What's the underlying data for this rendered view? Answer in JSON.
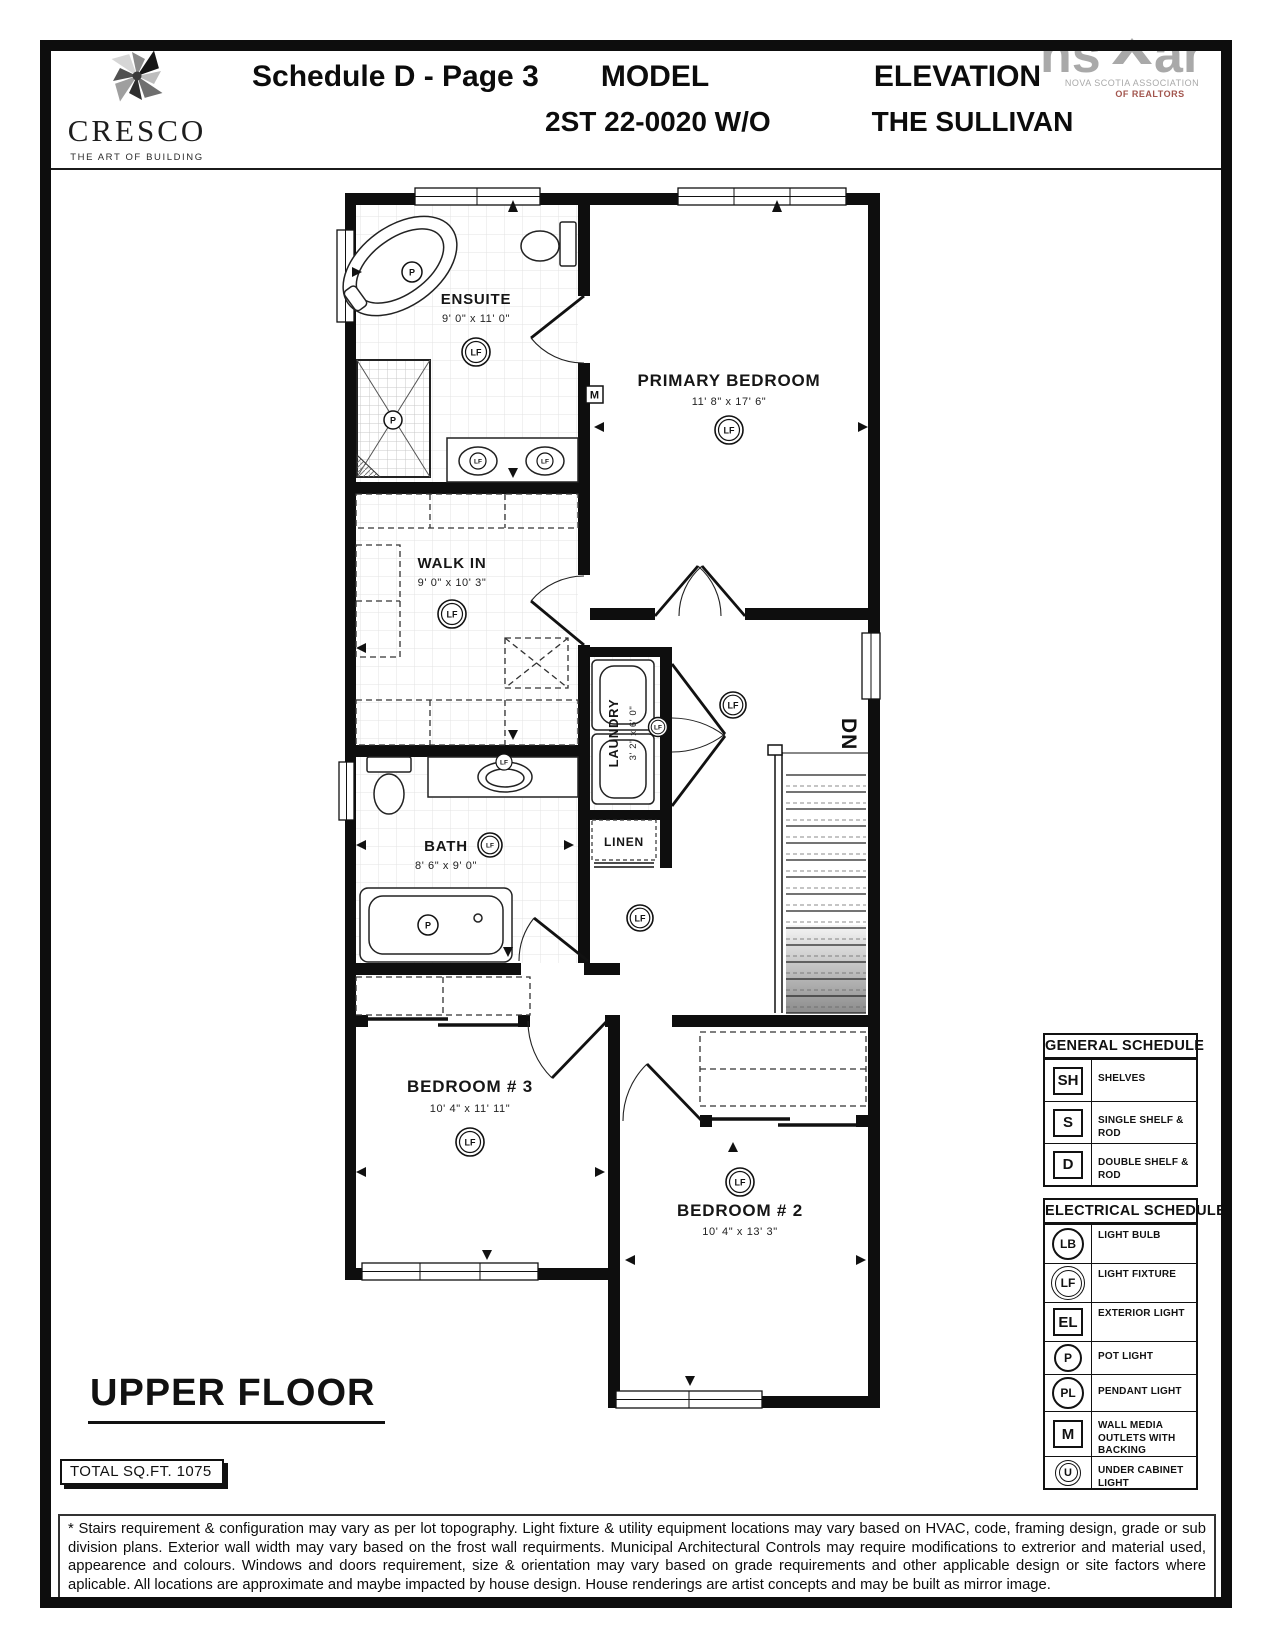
{
  "colors": {
    "ink": "#111111",
    "nsar_grey": "#a9a9a9",
    "realtors_red": "#a2554d",
    "tile_line": "#e3e3e3",
    "stair_shade": "#8c8c8c"
  },
  "header": {
    "cresco_name": "CRESCO",
    "cresco_tagline": "THE ART OF BUILDING",
    "schedule_title": "Schedule D - Page 3",
    "model_label": "MODEL",
    "model_value": "2ST 22-0020 W/O",
    "elevation_label": "ELEVATION",
    "elevation_value": "THE SULLIVAN",
    "nsar": {
      "logo_left": "ns",
      "logo_right": "ar",
      "org_line1": "NOVA SCOTIA ASSOCIATION",
      "org_line2": "OF REALTORS"
    }
  },
  "floorplan": {
    "floor_title": "UPPER FLOOR",
    "total_sqft": "TOTAL SQ.FT. 1075",
    "stairs_label": "DN",
    "symbols": {
      "light_fixture": "LF",
      "pot_light": "P",
      "media_outlet": "M"
    },
    "rooms": [
      {
        "name": "ENSUITE",
        "dims": "9' 0\" x 11' 0\""
      },
      {
        "name": "PRIMARY BEDROOM",
        "dims": "11' 8\" x 17' 6\""
      },
      {
        "name": "WALK IN",
        "dims": "9' 0\" x 10' 3\""
      },
      {
        "name": "LAUNDRY",
        "dims": "3' 2\" x 6' 0\""
      },
      {
        "name": "LINEN",
        "dims": ""
      },
      {
        "name": "BATH",
        "dims": "8' 6\" x 9' 0\""
      },
      {
        "name": "BEDROOM # 3",
        "dims": "10' 4\" x 11' 11\""
      },
      {
        "name": "BEDROOM # 2",
        "dims": "10' 4\" x 13' 3\""
      }
    ]
  },
  "general_schedule": {
    "title": "GENERAL SCHEDULE",
    "rows": [
      {
        "symbol": "SH",
        "label": "SHELVES"
      },
      {
        "symbol": "S",
        "label": "SINGLE SHELF & ROD"
      },
      {
        "symbol": "D",
        "label": "DOUBLE SHELF & ROD"
      }
    ]
  },
  "electrical_schedule": {
    "title": "ELECTRICAL SCHEDULE",
    "rows": [
      {
        "symbol": "LB",
        "shape": "circle",
        "label": "LIGHT BULB"
      },
      {
        "symbol": "LF",
        "shape": "double-circle",
        "label": "LIGHT FIXTURE"
      },
      {
        "symbol": "EL",
        "shape": "square",
        "label": "EXTERIOR LIGHT"
      },
      {
        "symbol": "P",
        "shape": "circle",
        "label": "POT LIGHT"
      },
      {
        "symbol": "PL",
        "shape": "circle",
        "label": "PENDANT LIGHT"
      },
      {
        "symbol": "M",
        "shape": "square",
        "label": "WALL MEDIA OUTLETS WITH BACKING"
      },
      {
        "symbol": "U",
        "shape": "double-circle",
        "label": "UNDER CABINET LIGHT"
      }
    ]
  },
  "disclaimer": "* Stairs requirement & configuration may vary as per lot topography. Light fixture & utility equipment locations may vary based on HVAC, code, framing design, grade or sub division plans. Exterior wall width may vary based on the frost wall requirments. Municipal Architectural Controls may require modifications to extrerior and material used, appearence and colours. Windows and doors requirement, size & orientation may vary based on grade requirements and other applicable design or site factors where aplicable. All locations are approximate and maybe impacted by house design. House renderings are artist concepts and may be built as mirror image."
}
